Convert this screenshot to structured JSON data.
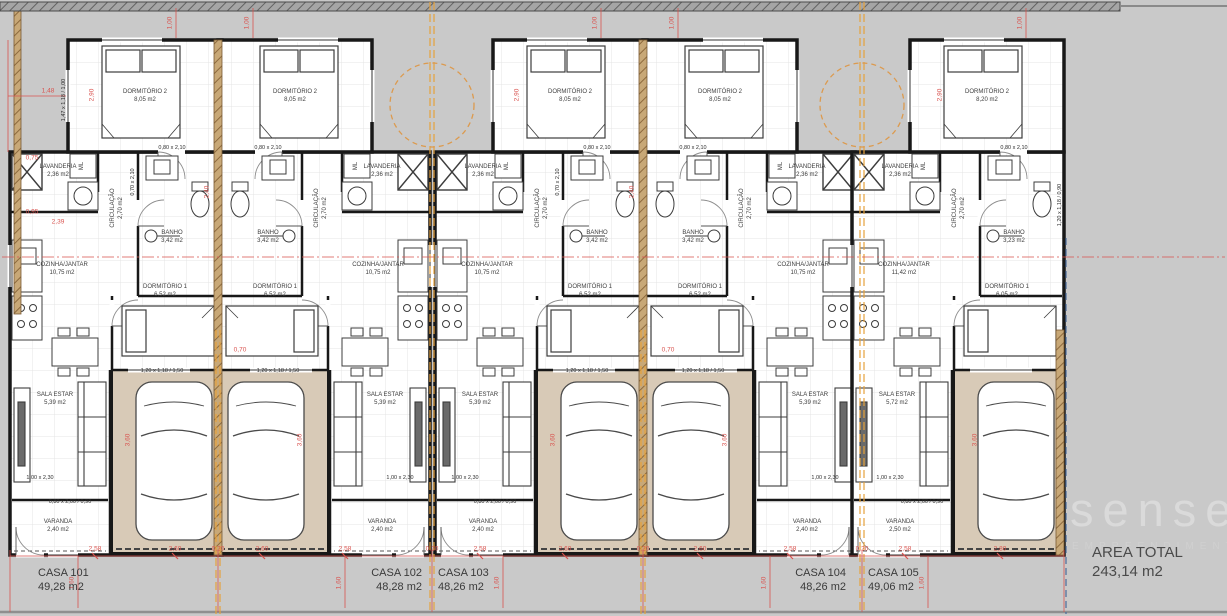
{
  "watermark": {
    "brand": "sense",
    "subtitle": "EMPREENDIMENTOS"
  },
  "footer": {
    "area_total_label": "AREA TOTAL",
    "area_total_value": "243,14 m2"
  },
  "houses": [
    {
      "label": "CASA 101",
      "area": "49,28 m2",
      "rooms": {
        "dorm2": {
          "name": "DORMITÓRIO 2",
          "area": "8,05 m2"
        },
        "circ": {
          "name": "CIRCULAÇÃO",
          "area": "2,70 m2"
        },
        "lav": {
          "name": "LAVANDERIA",
          "area": "2,36 m2"
        },
        "ml": "ML",
        "banho": {
          "name": "BANHO",
          "area": "3,42 m2"
        },
        "coz": {
          "name": "COZINHA/JANTAR",
          "area": "10,75 m2"
        },
        "dorm1": {
          "name": "DORMITÓRIO 1",
          "area": "6,52 m2"
        },
        "sala": {
          "name": "SALA ESTAR",
          "area": "5,39 m2"
        },
        "var": {
          "name": "VARANDA",
          "area": "2,40 m2"
        }
      }
    },
    {
      "label": "CASA 102",
      "area": "48,28 m2",
      "rooms": {
        "dorm2": {
          "name": "DORMITÓRIO 2",
          "area": "8,05 m2"
        },
        "circ": {
          "name": "CIRCULAÇÃO",
          "area": "2,70 m2"
        },
        "lav": {
          "name": "LAVANDERIA",
          "area": "2,36 m2"
        },
        "ml": "ML",
        "banho": {
          "name": "BANHO",
          "area": "3,42 m2"
        },
        "coz": {
          "name": "COZINHA/JANTAR",
          "area": "10,75 m2"
        },
        "dorm1": {
          "name": "DORMITÓRIO 1",
          "area": "6,52 m2"
        },
        "sala": {
          "name": "SALA ESTAR",
          "area": "5,39 m2"
        },
        "var": {
          "name": "VARANDA",
          "area": "2,40 m2"
        }
      }
    },
    {
      "label": "CASA 103",
      "area": "48,26 m2",
      "rooms": {
        "dorm2": {
          "name": "DORMITÓRIO 2",
          "area": "8,05 m2"
        },
        "circ": {
          "name": "CIRCULAÇÃO",
          "area": "2,70 m2"
        },
        "lav": {
          "name": "LAVANDERIA",
          "area": "2,36 m2"
        },
        "ml": "ML",
        "banho": {
          "name": "BANHO",
          "area": "3,42 m2"
        },
        "coz": {
          "name": "COZINHA/JANTAR",
          "area": "10,75 m2"
        },
        "dorm1": {
          "name": "DORMITÓRIO 1",
          "area": "6,52 m2"
        },
        "sala": {
          "name": "SALA ESTAR",
          "area": "5,39 m2"
        },
        "var": {
          "name": "VARANDA",
          "area": "2,40 m2"
        }
      }
    },
    {
      "label": "CASA 104",
      "area": "48,26 m2",
      "rooms": {
        "dorm2": {
          "name": "DORMITÓRIO 2",
          "area": "8,05 m2"
        },
        "circ": {
          "name": "CIRCULAÇÃO",
          "area": "2,70 m2"
        },
        "lav": {
          "name": "LAVANDERIA",
          "area": "2,36 m2"
        },
        "ml": "ML",
        "banho": {
          "name": "BANHO",
          "area": "3,42 m2"
        },
        "coz": {
          "name": "COZINHA/JANTAR",
          "area": "10,75 m2"
        },
        "dorm1": {
          "name": "DORMITÓRIO 1",
          "area": "6,52 m2"
        },
        "sala": {
          "name": "SALA ESTAR",
          "area": "5,39 m2"
        },
        "var": {
          "name": "VARANDA",
          "area": "2,40 m2"
        }
      }
    },
    {
      "label": "CASA 105",
      "area": "49,06 m2",
      "rooms": {
        "dorm2": {
          "name": "DORMITÓRIO 2",
          "area": "8,20 m2"
        },
        "circ": {
          "name": "CIRCULAÇÃO",
          "area": "2,70 m2"
        },
        "lav": {
          "name": "LAVANDERIA",
          "area": "2,36 m2"
        },
        "ml": "ML",
        "banho": {
          "name": "BANHO",
          "area": "3,23 m2"
        },
        "coz": {
          "name": "COZINHA/JANTAR",
          "area": "11,42 m2"
        },
        "dorm1": {
          "name": "DORMITÓRIO 1",
          "area": "6,05 m2"
        },
        "sala": {
          "name": "SALA ESTAR",
          "area": "5,72 m2"
        },
        "var": {
          "name": "VARANDA",
          "area": "2,50 m2"
        }
      }
    }
  ],
  "dims": {
    "d258": "2,58",
    "d260": "2,60",
    "d020": "0,20",
    "d280": "2,80",
    "d160": "1,60",
    "d100": "1,00",
    "d360": "3,60",
    "d290": "2,90",
    "d240": "2,40",
    "d148": "1,48",
    "d075": "0,75",
    "d095": "0,95",
    "d239": "2,39",
    "d070": "0,70"
  },
  "openings": {
    "door_bed": "0,80 x 2,10",
    "door_bath": "0,70 x 2,10",
    "door_front": "1,00 x 2,30",
    "win_living": "0,80 x 2,00 / 0,90",
    "win_front": "1,20 x 1,18 / 1,50",
    "win_side": "1,20 x 1,18 / 0,90",
    "win_bed": "1,47 x 1,18 / 1,00"
  }
}
